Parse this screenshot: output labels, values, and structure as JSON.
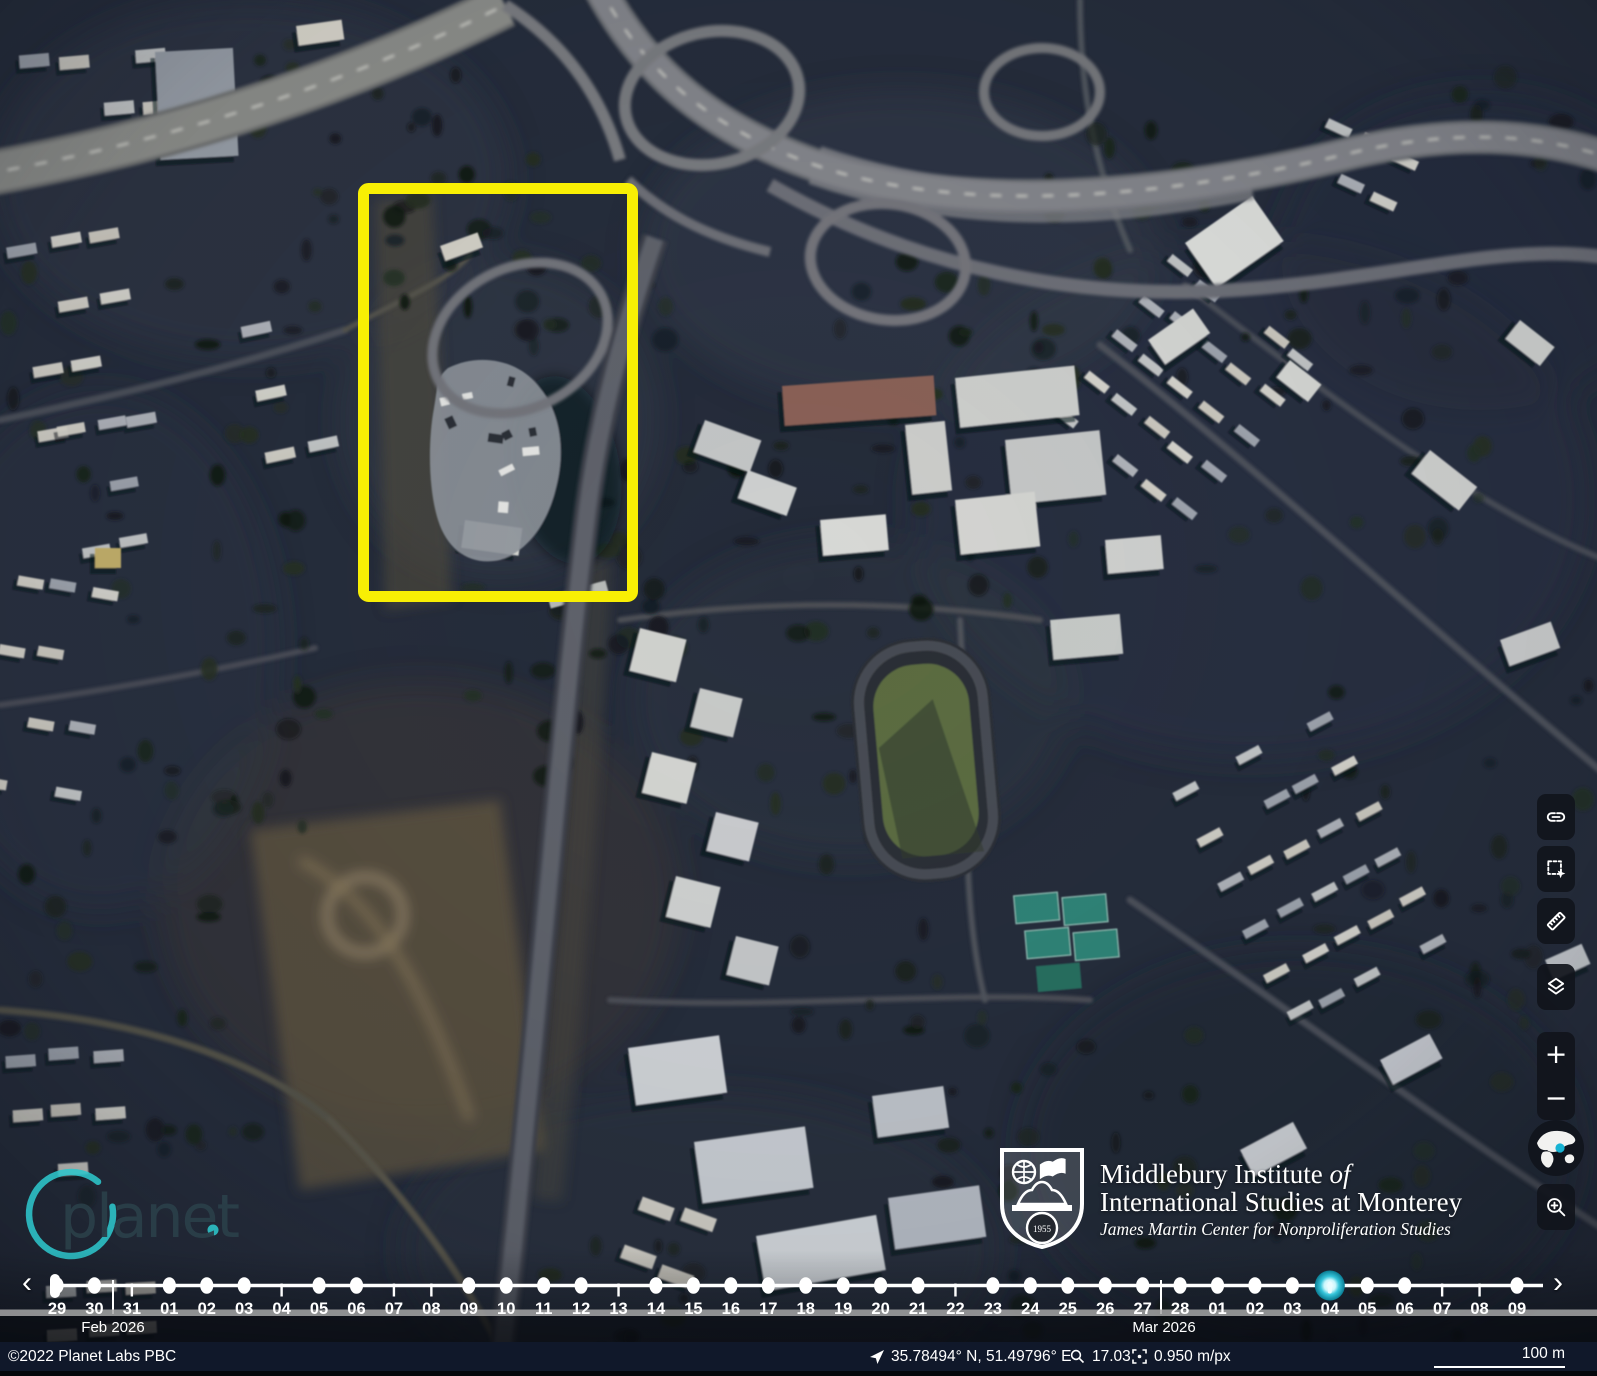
{
  "watermark": {
    "text": "planet",
    "dot": "."
  },
  "institute": {
    "name_line1": "Middlebury Institute ",
    "name_line1_italic": "of",
    "name_line2": "International Studies at Monterey",
    "subtitle": "James Martin Center for Nonproliferation Studies",
    "shield_year": "1955"
  },
  "toolbar": {
    "buttons": [
      {
        "name": "share-link"
      },
      {
        "name": "select-area"
      },
      {
        "name": "measure"
      },
      {
        "name": "layers"
      }
    ],
    "zoom_in_glyph": "+",
    "zoom_out_glyph": "−"
  },
  "timeline": {
    "prev_glyph": "‹",
    "next_glyph": "›",
    "months": [
      {
        "label": "Feb 2026"
      },
      {
        "label": "Mar 2026"
      }
    ],
    "selected_day": "04",
    "selected_color": "#18b5cd",
    "days": [
      {
        "label": "29",
        "marker": "dot"
      },
      {
        "label": "30",
        "marker": "dot"
      },
      {
        "label": "31",
        "marker": "tick"
      },
      {
        "label": "01",
        "marker": "dot"
      },
      {
        "label": "02",
        "marker": "dot"
      },
      {
        "label": "03",
        "marker": "dot"
      },
      {
        "label": "04",
        "marker": "tick"
      },
      {
        "label": "05",
        "marker": "dot"
      },
      {
        "label": "06",
        "marker": "dot"
      },
      {
        "label": "07",
        "marker": "tick"
      },
      {
        "label": "08",
        "marker": "tick"
      },
      {
        "label": "09",
        "marker": "dot"
      },
      {
        "label": "10",
        "marker": "dot"
      },
      {
        "label": "11",
        "marker": "dot"
      },
      {
        "label": "12",
        "marker": "dot"
      },
      {
        "label": "13",
        "marker": "tick"
      },
      {
        "label": "14",
        "marker": "dot"
      },
      {
        "label": "15",
        "marker": "dot"
      },
      {
        "label": "16",
        "marker": "dot"
      },
      {
        "label": "17",
        "marker": "dot"
      },
      {
        "label": "18",
        "marker": "dot"
      },
      {
        "label": "19",
        "marker": "dot"
      },
      {
        "label": "20",
        "marker": "dot"
      },
      {
        "label": "21",
        "marker": "dot"
      },
      {
        "label": "22",
        "marker": "tick"
      },
      {
        "label": "23",
        "marker": "dot"
      },
      {
        "label": "24",
        "marker": "dot"
      },
      {
        "label": "25",
        "marker": "dot"
      },
      {
        "label": "26",
        "marker": "dot"
      },
      {
        "label": "27",
        "marker": "dot"
      },
      {
        "label": "28",
        "marker": "dot"
      },
      {
        "label": "01",
        "marker": "dot"
      },
      {
        "label": "02",
        "marker": "dot"
      },
      {
        "label": "03",
        "marker": "dot"
      },
      {
        "label": "04",
        "marker": "selected"
      },
      {
        "label": "05",
        "marker": "dot"
      },
      {
        "label": "06",
        "marker": "dot"
      },
      {
        "label": "07",
        "marker": "tick"
      },
      {
        "label": "08",
        "marker": "tick"
      },
      {
        "label": "09",
        "marker": "dot"
      }
    ]
  },
  "statusbar": {
    "copyright": "©2022 Planet Labs PBC",
    "coordinates": "35.78494° N, 51.49796° E",
    "zoom_level": "17.03",
    "resolution": "0.950 m/px",
    "scale_label": "100 m"
  },
  "map": {
    "annotation_color": "#f8ef04"
  }
}
